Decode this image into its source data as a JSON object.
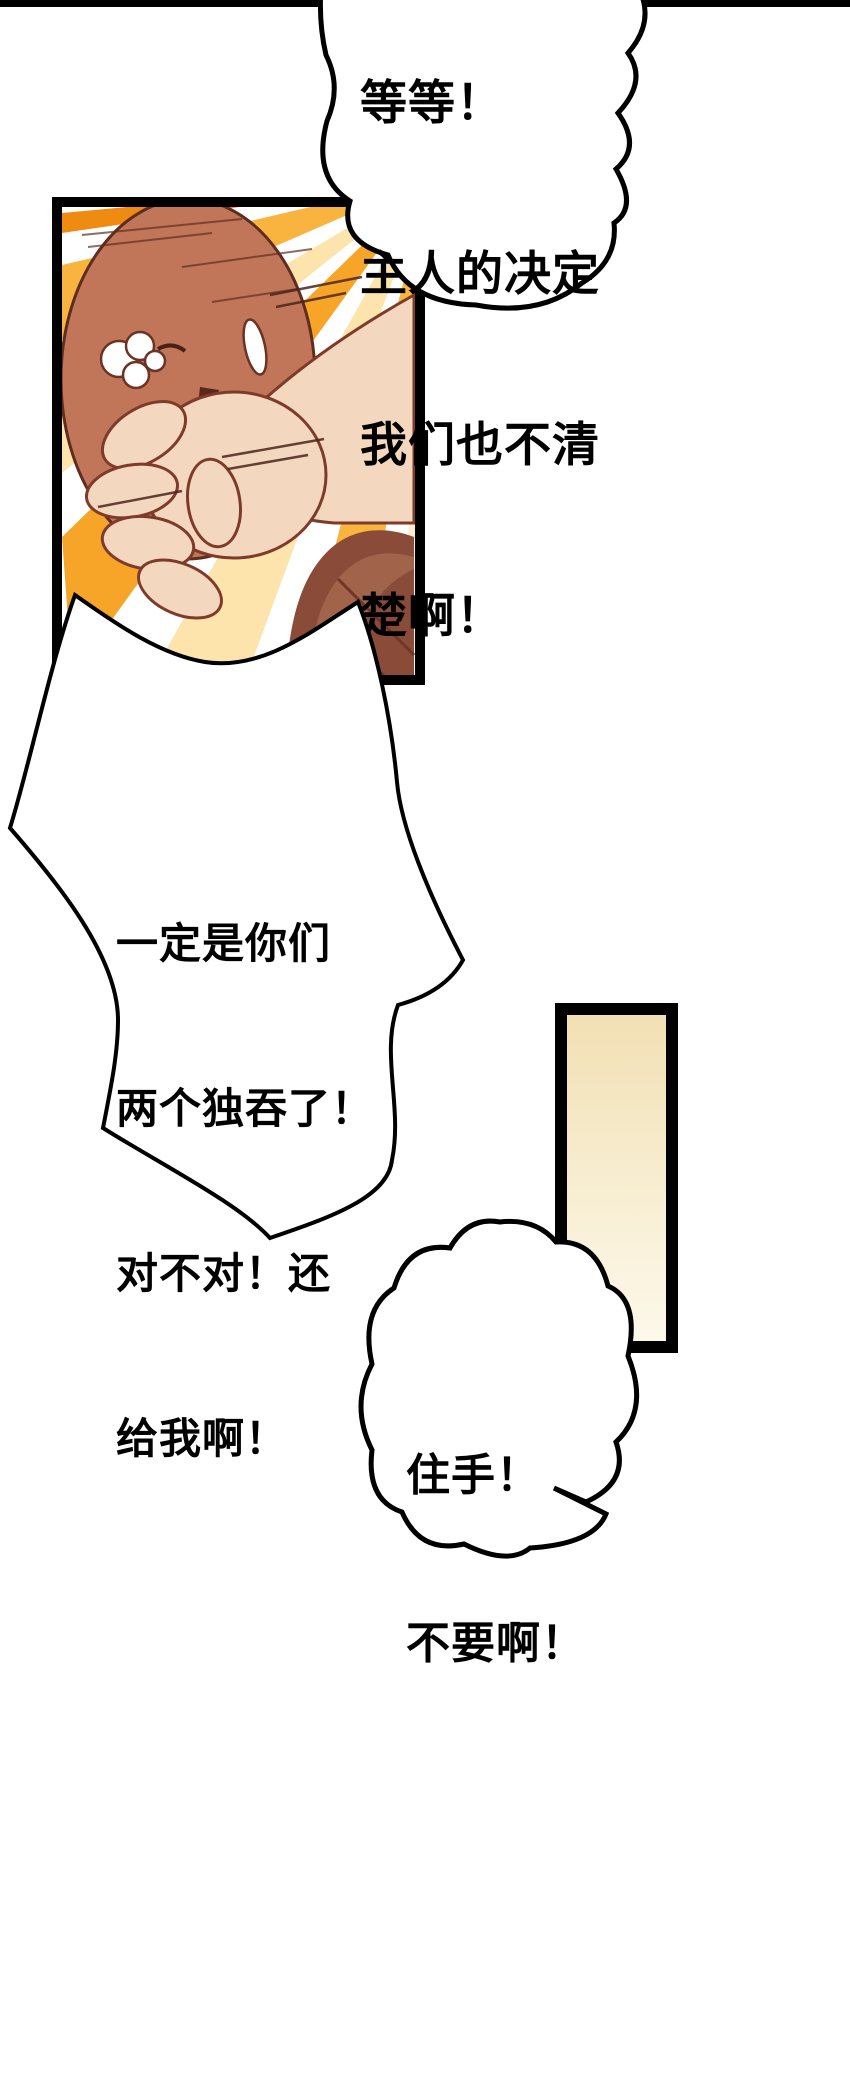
{
  "page": {
    "type": "comic-page",
    "background": "#ffffff",
    "gutter_rule_color": "#000000"
  },
  "panels": [
    {
      "id": "panel-action",
      "description": "close-up: auburn-haired character silenced by a fist, orange speed-line burst",
      "border_color": "#000000",
      "colors": {
        "speedline_strong": "#f7a528",
        "speedline_mid": "#f9b43f",
        "speedline_soft": "#fde4ad",
        "hair": "#c1765a",
        "hair_dark": "#8a4b38",
        "skin": "#f3d8bf",
        "outline": "#6b3323",
        "mouth": "#5c261a"
      }
    },
    {
      "id": "panel-strip",
      "description": "tall empty vertical panel, warm cream gradient",
      "border_color": "#000000",
      "colors": {
        "top": "#f2e0b4",
        "bottom": "#fdf8ea"
      }
    }
  ],
  "bubbles": [
    {
      "id": "bubble-top",
      "shape": "cloud",
      "lines": [
        "等等！",
        "主人的决定",
        "我们也不清",
        "楚啊！"
      ]
    },
    {
      "id": "bubble-middle",
      "shape": "spiky",
      "lines": [
        "一定是你们",
        "两个独吞了！",
        "对不对！还",
        "给我啊！"
      ]
    },
    {
      "id": "bubble-small",
      "shape": "cloud",
      "lines": [
        "住手！",
        "不要啊！"
      ]
    }
  ]
}
